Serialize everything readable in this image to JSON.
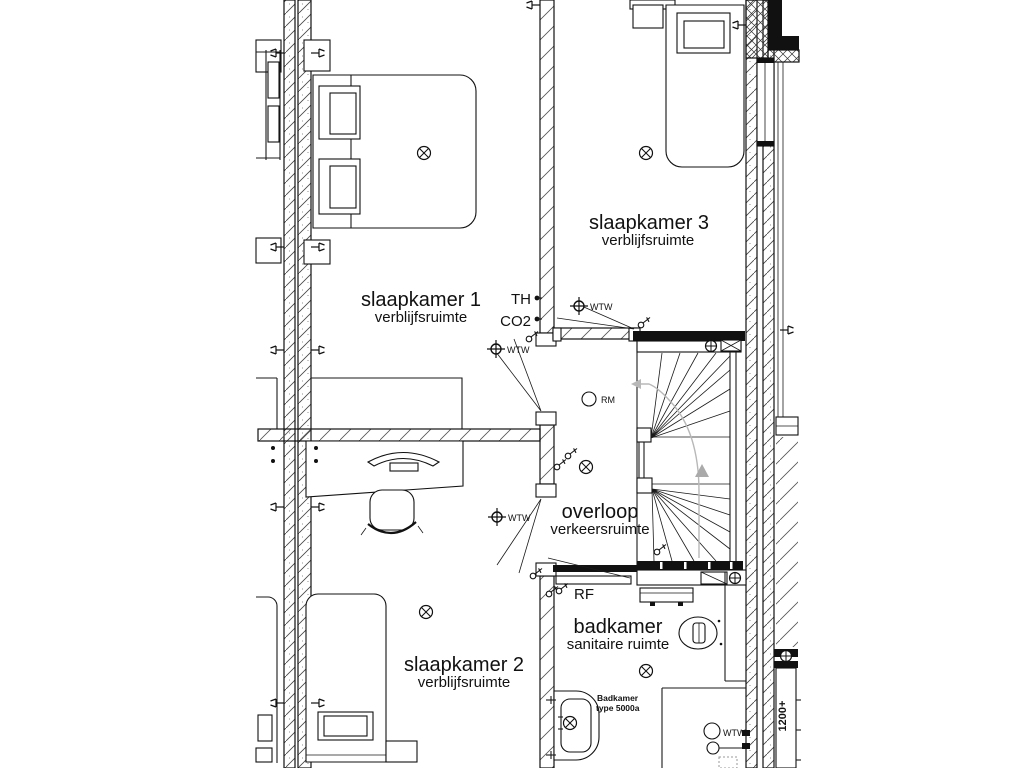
{
  "plan": {
    "title": "floor-plan upper storey",
    "colors": {
      "ink": "#1a1a1a",
      "paper": "#ffffff",
      "walk_line": "#b8b8b8"
    }
  },
  "rooms": {
    "slaapkamer1": {
      "name": "slaapkamer 1",
      "function": "verblijfsruimte"
    },
    "slaapkamer2": {
      "name": "slaapkamer 2",
      "function": "verblijfsruimte"
    },
    "slaapkamer3": {
      "name": "slaapkamer 3",
      "function": "verblijfsruimte"
    },
    "overloop": {
      "name": "overloop",
      "function": "verkeersruimte"
    },
    "badkamer": {
      "name": "badkamer",
      "function": "sanitaire ruimte"
    }
  },
  "annotations": {
    "thermostat": "TH",
    "co2": "CO2",
    "wtw_valve": "WTW",
    "smoke_detector": "RM",
    "rf": "RF",
    "bath_spec_line1": "Badkamer",
    "bath_spec_line2": "type 5000a",
    "mv_unit": "WTW",
    "sill_height": "1200+"
  }
}
